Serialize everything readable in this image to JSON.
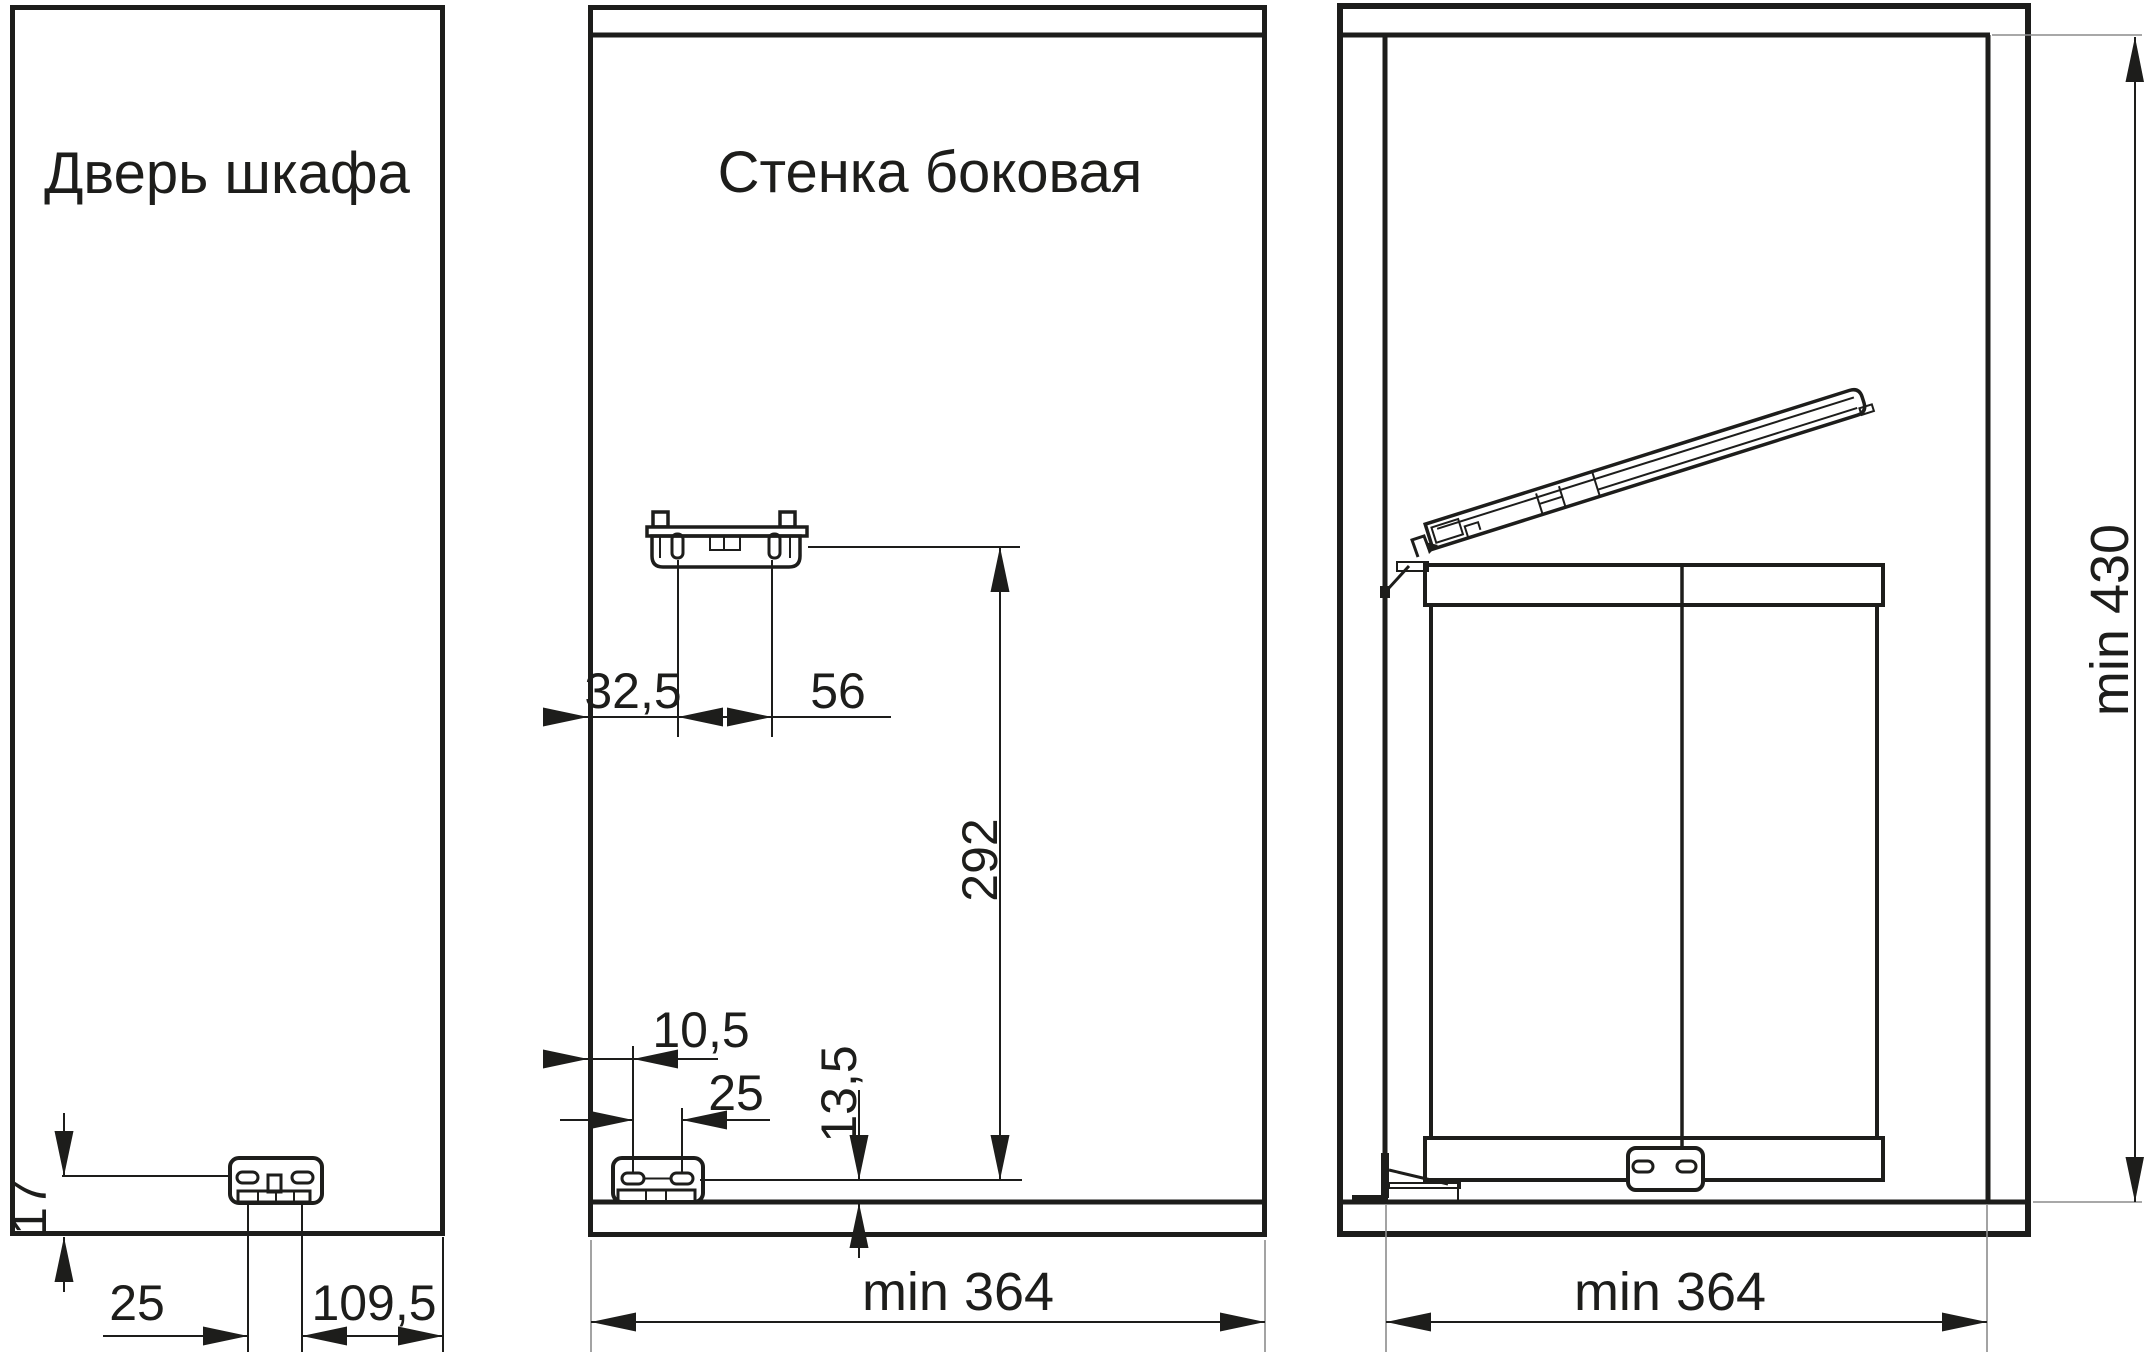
{
  "drawing": {
    "door": {
      "title": "Дверь шкафа",
      "dim_height_from_bottom": "17",
      "dim_hole_spacing": "25",
      "dim_edge_distance": "109,5"
    },
    "side_wall": {
      "title": "Стенка боковая",
      "dim_top_front_offset": "32,5",
      "dim_top_hole_spacing": "56",
      "dim_bottom_front_offset": "10,5",
      "dim_bottom_hole_spacing": "25",
      "dim_axis_to_bottom": "13,5",
      "dim_axis_height": "292",
      "dim_depth": "min 364"
    },
    "cabinet": {
      "dim_inner_width": "min 364",
      "dim_inner_height": "min 430"
    }
  },
  "colors": {
    "line": "#1d1d1b",
    "extension": "#8c8c8c",
    "background": "#ffffff"
  }
}
